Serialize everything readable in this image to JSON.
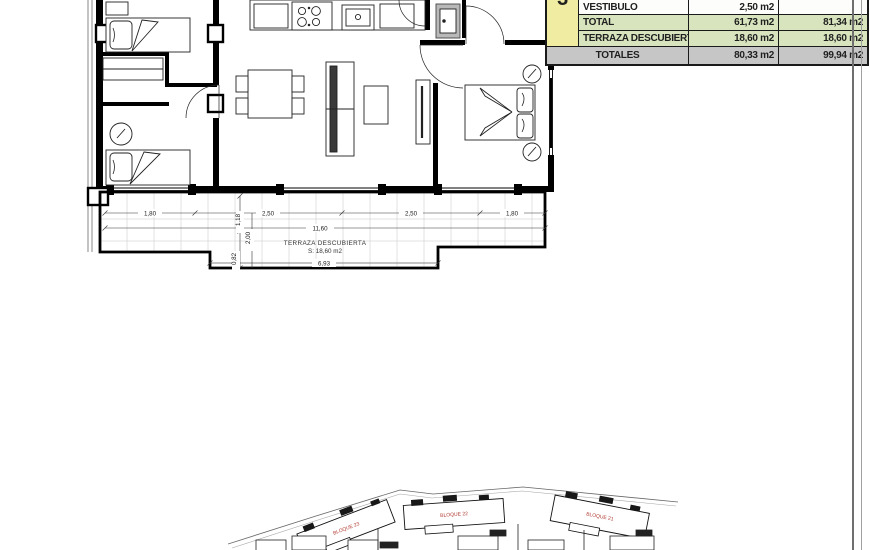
{
  "area_table": {
    "group_number": "3",
    "rows": [
      {
        "label": "VESTIBULO",
        "superficie": "2,50 m2",
        "construida": ""
      },
      {
        "label": "TOTAL",
        "superficie": "61,73 m2",
        "construida": "81,34 m2"
      },
      {
        "label": "TERRAZA DESCUBIERTA",
        "superficie": "18,60 m2",
        "construida": "18,60 m2"
      }
    ],
    "totals_row": {
      "label": "TOTALES",
      "superficie": "80,33 m2",
      "construida": "99,94 m2"
    }
  },
  "floor_plan": {
    "terrace": {
      "name": "TERRAZA DESCUBIERTA",
      "area": "S: 18,60 m2"
    },
    "dimensions": {
      "bottom_segments": [
        "1,80",
        "2,50",
        "2,50",
        "1,80"
      ],
      "overall_width": "11,60",
      "terrace_width": "6,93",
      "vertical_segments": [
        "1,18",
        "2,00",
        "0,82"
      ]
    }
  },
  "site_plan": {
    "blocks": [
      {
        "label": "BLOQUE 23"
      },
      {
        "label": "BLOQUE 22"
      },
      {
        "label": "BLOQUE 21"
      }
    ]
  },
  "colors": {
    "table_green": "#d7e4be",
    "table_yellow": "#f0eca2",
    "table_gray": "#c6c6c6",
    "block_label_red": "#b03a30",
    "dim_text": "#222222"
  }
}
